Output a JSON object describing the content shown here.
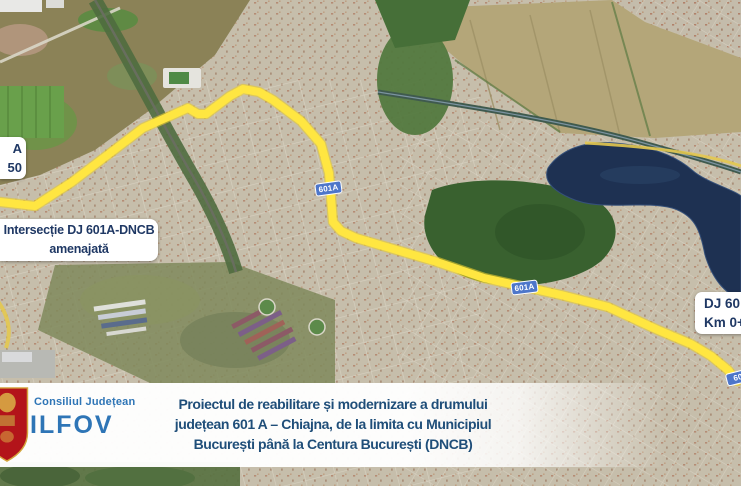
{
  "map": {
    "labels": {
      "left_cut": {
        "line1": "A",
        "line2": "50"
      },
      "intersection": {
        "line1": "Intersecție DJ 601A-DNCB",
        "line2": "amenajată"
      },
      "right_cut": {
        "line1": "DJ 60",
        "line2": "Km 0+"
      }
    },
    "shields": {
      "s1": "601A",
      "s2": "601A",
      "s3": "60"
    },
    "colors": {
      "route_yellow": "#ffe641",
      "shield_blue": "#4d76ca",
      "label_navy": "#1f3864",
      "lake_blue": "#1e3152",
      "forest_green": "#39612f"
    }
  },
  "banner": {
    "org_small": "Consiliul Județean",
    "org_large": "ILFOV",
    "title_line1": "Proiectul de reabilitare și modernizare a drumului",
    "title_line2": "județean 601 A – Chiajna, de la limita cu Municipiul",
    "title_line3": "București până la Centura București (DNCB)",
    "colors": {
      "brand_blue": "#2e75b6",
      "title_navy": "#1f4e79",
      "crest_red": "#b3141a"
    }
  }
}
